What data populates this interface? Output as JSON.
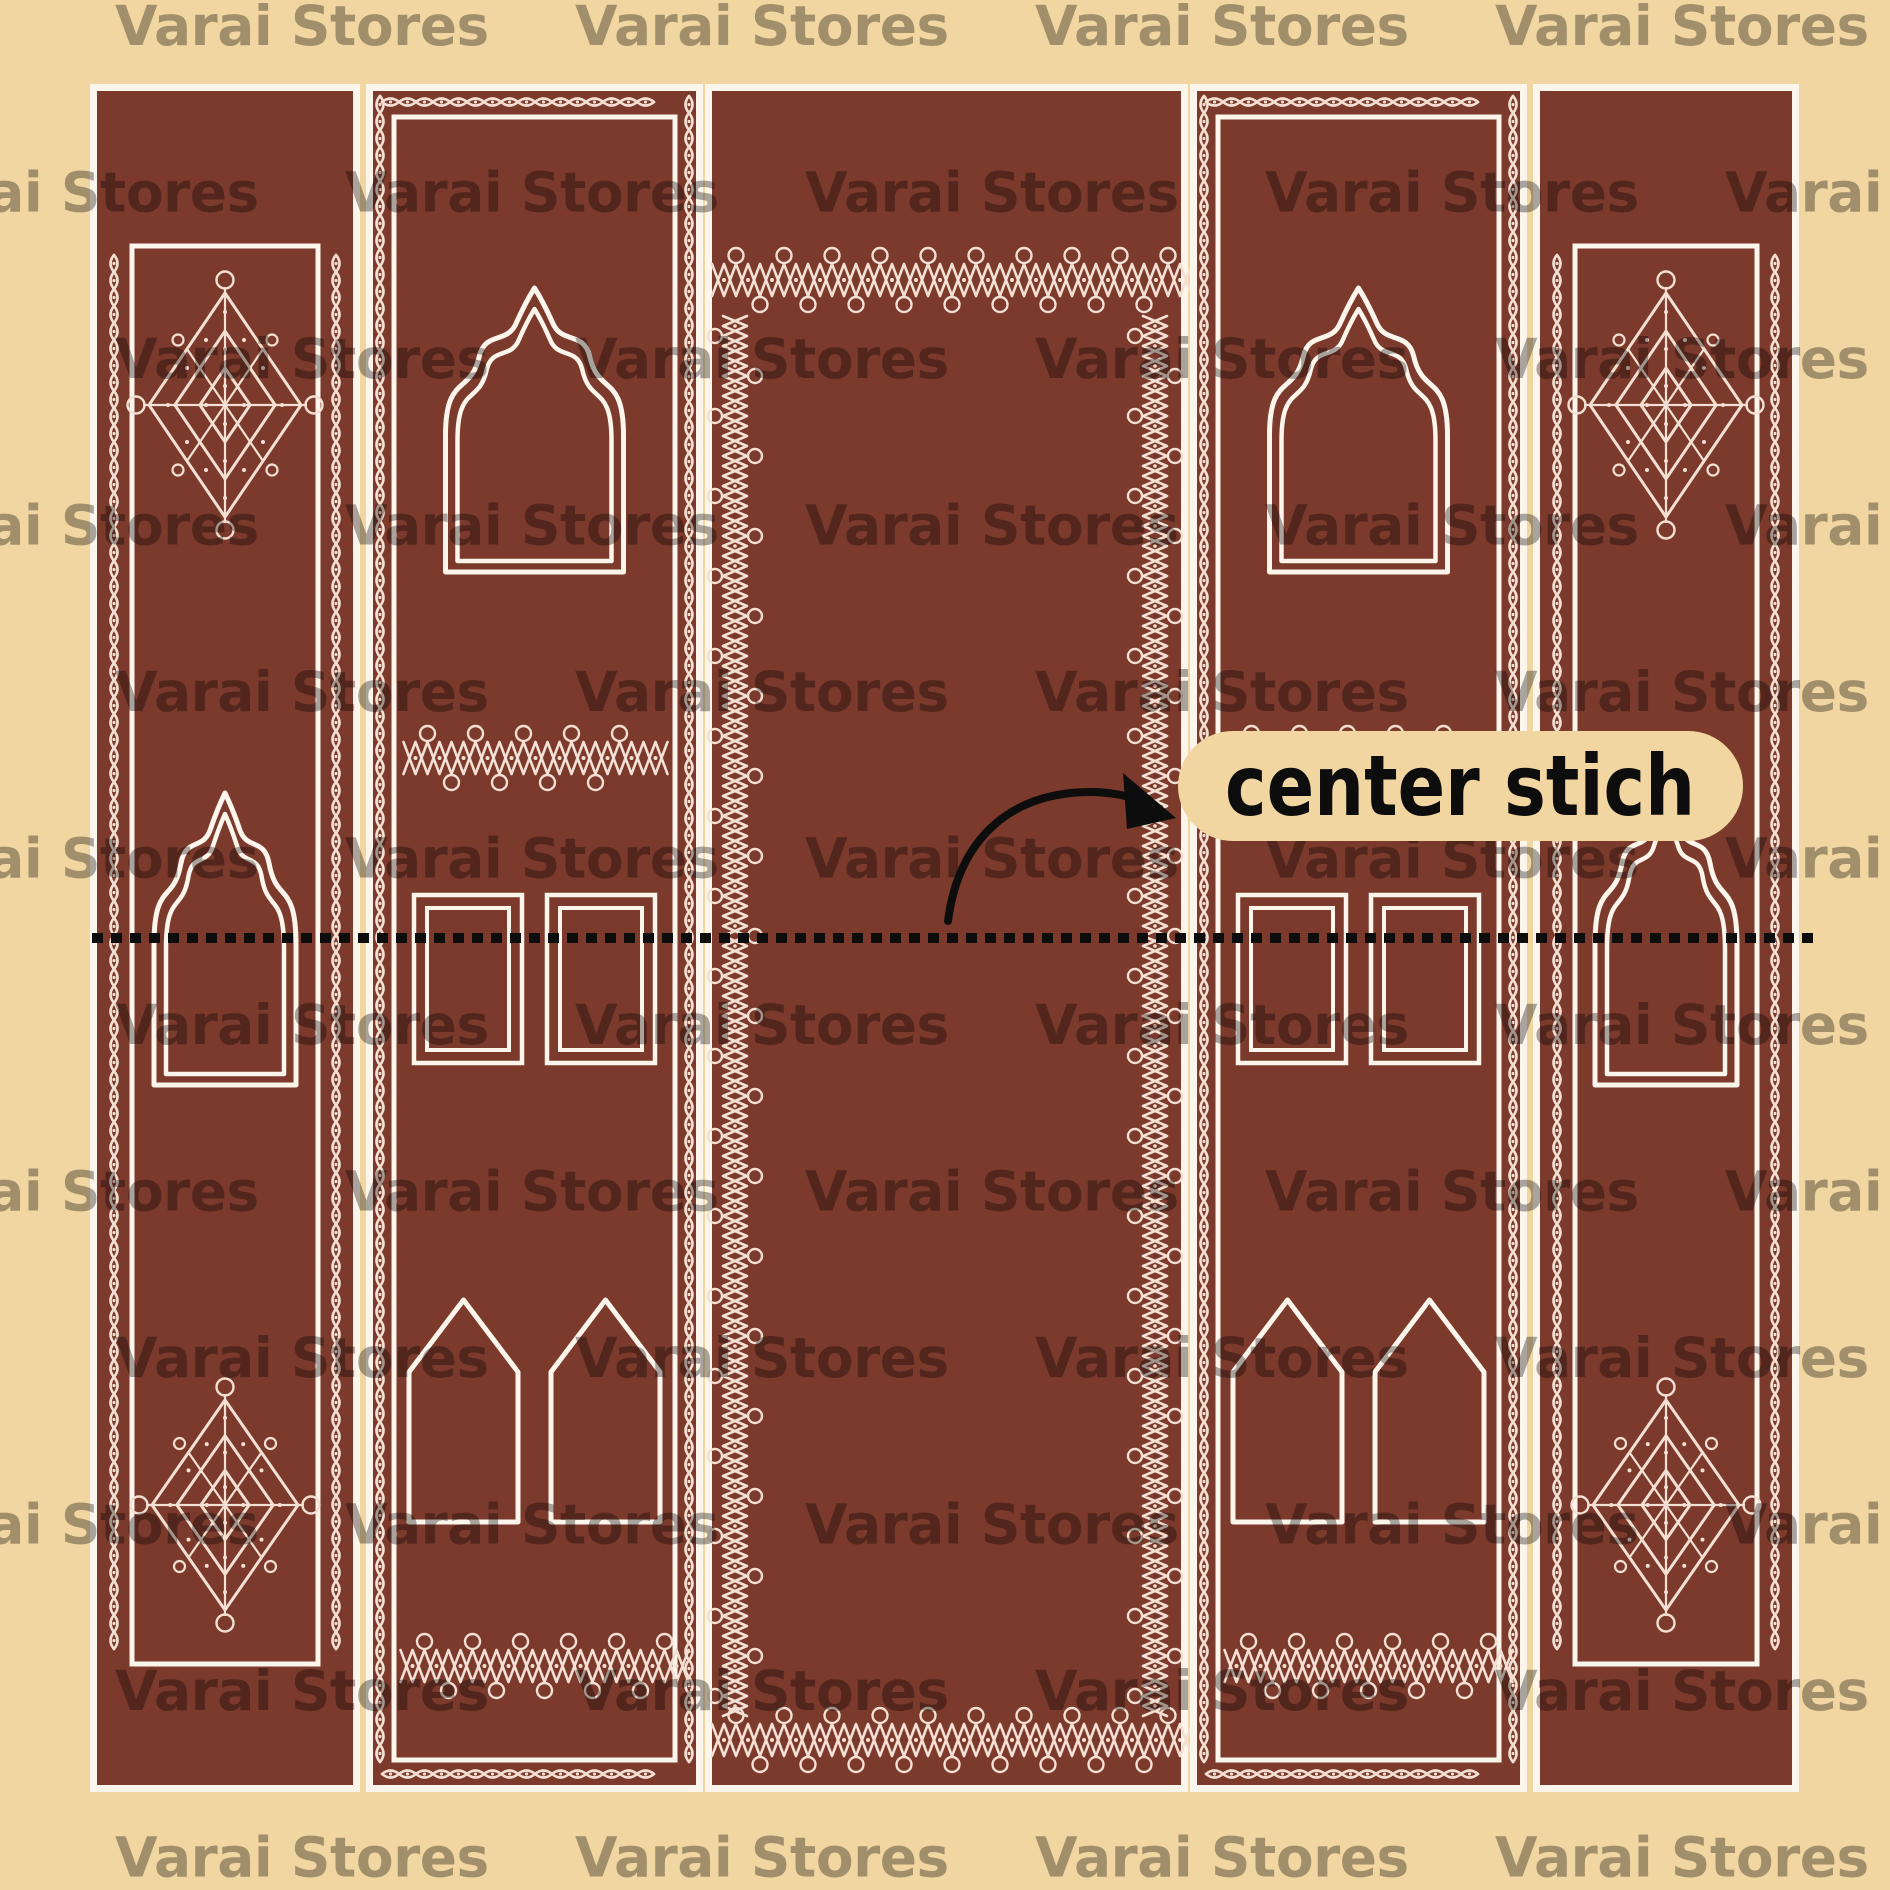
{
  "artwork": {
    "watermark": {
      "text": "Varai Stores",
      "opacity": 0.33
    },
    "annotation": {
      "label": "center stich"
    },
    "colors": {
      "background": "#F2D6A1",
      "panel": "#7B3A2C",
      "border_line": "#FCF5EC",
      "kolam_line": "#F3E0D3",
      "ink": "#0D0D0D"
    },
    "panels": [
      {
        "name": "left-border-strip"
      },
      {
        "name": "left-door-strip"
      },
      {
        "name": "center-field"
      },
      {
        "name": "right-door-strip"
      },
      {
        "name": "right-border-strip"
      }
    ],
    "stitch_line": {
      "style": "dotted"
    }
  }
}
